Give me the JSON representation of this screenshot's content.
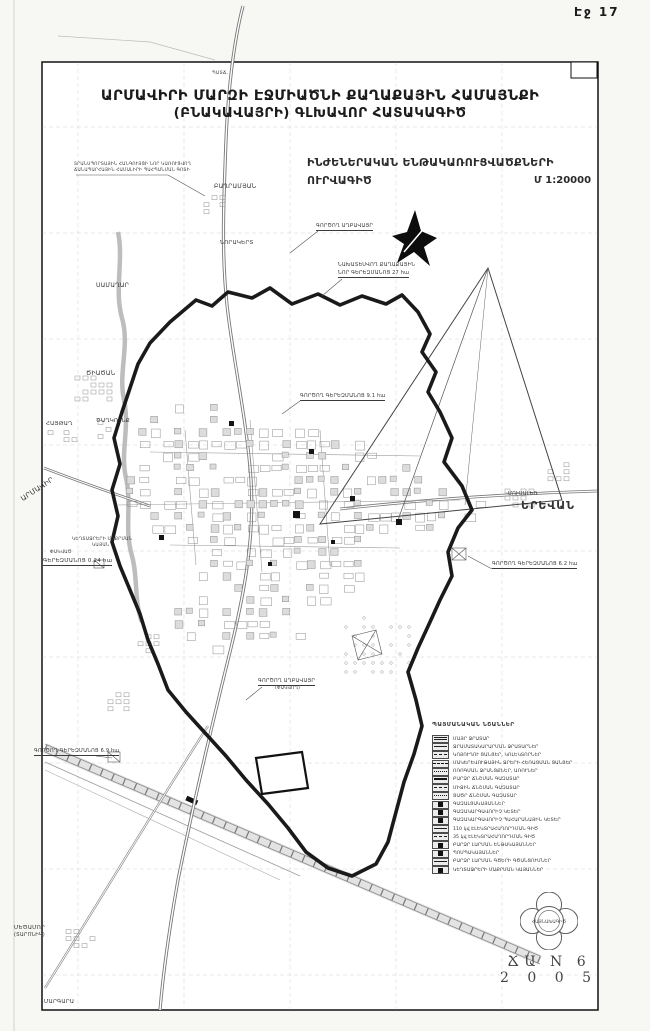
{
  "page": {
    "number_label": "Էջ 17"
  },
  "titles": {
    "line1": "ԱՐՄԱՎԻՐԻ ՄԱՐԶԻ ԷՋՄԻԱԾՆԻ ՔԱՂԱՔԱՅԻՆ ՀԱՄԱՅՆՔԻ",
    "line2": "(ԲՆԱԿԱՎԱՅՐԻ) ԳԼԽԱՎՈՐ ՀԱՏԱԿԱԳԻԾ",
    "subtitle_line1": "ԻՆԺԵՆԵՐԱԿԱՆ ԵՆԹԱԿԱՌՈՒՑՎԱԾՔՆԵՐԻ",
    "subtitle_line2": "ՈՒՐՎԱԳԻԾ",
    "scale": "Մ 1:20000"
  },
  "map_labels": [
    {
      "t": "ՊԱՏՃ.",
      "x": 212,
      "y": 72,
      "s": 4.5
    },
    {
      "t": "ՏՐԱՆՍՊՈՐՏԱՅԻՆ ՀԱՆԳՈՒՅՑԻ ՆՈՐ ԿԱՌՈՒՑՎՈՂ",
      "x": 74,
      "y": 163,
      "s": 4.3
    },
    {
      "t": "ՃԱՆԱՊԱՐՀԱՅԻՆ ՀԱՄԱԼԻՐԻ ՊԱՀՊԱՆՄԱՆ ԳՈՏԻ",
      "x": 74,
      "y": 169,
      "s": 4.3
    },
    {
      "t": "ԲԱՂՐԱՄՅԱՆ",
      "x": 214,
      "y": 184,
      "s": 6
    },
    {
      "t": "ՆՈՐԱԿԵՐՏ",
      "x": 220,
      "y": 240,
      "s": 5.5
    },
    {
      "t": "ԳՈՐԾՈՂ ԱՂԲԱՎԱՅՐ",
      "x": 316,
      "y": 224,
      "s": 5,
      "u": 1
    },
    {
      "t": "ՆԱԽԱՏԵՍՎՈՂ ՔԱՂԱՔԱՅԻՆ",
      "x": 338,
      "y": 263,
      "s": 5
    },
    {
      "t": "ՆՈՐ ԳԵՐԵԶՄԱՆՈՑ 27 հա",
      "x": 338,
      "y": 271,
      "s": 5,
      "u": 1
    },
    {
      "t": "ՍԱՄԱՂԱՐ",
      "x": 96,
      "y": 283,
      "s": 6
    },
    {
      "t": "ԾԻԱԾԱՆ",
      "x": 86,
      "y": 371,
      "s": 6
    },
    {
      "t": "ԳՈՐԾՈՂ ԳԵՐԵԶՄԱՆՈՑ 9.1 հա",
      "x": 300,
      "y": 394,
      "s": 5,
      "u": 1
    },
    {
      "t": "ՀԱՅԹԱՂ",
      "x": 46,
      "y": 421,
      "s": 5.5
    },
    {
      "t": "ԾԱՂԿՈՒՆՔ",
      "x": 96,
      "y": 418,
      "s": 5.5
    },
    {
      "t": "ԱՐՄԱՎԻՐ",
      "x": 20,
      "y": 497,
      "s": 7,
      "r": -33
    },
    {
      "t": "ՄՈՒՍԱԼԵՌ",
      "x": 508,
      "y": 492,
      "s": 5
    },
    {
      "t": "ԵՐԵՎԱՆ",
      "x": 521,
      "y": 500,
      "s": 11,
      "w": 700,
      "ls": 1
    },
    {
      "t": "ԿԵՂՏԱՋՐԵՐԻ ՄԱՔՐՄԱՆ",
      "x": 72,
      "y": 538,
      "s": 4.4
    },
    {
      "t": "ԿԱՅԱՆ",
      "x": 92,
      "y": 544,
      "s": 4.4
    },
    {
      "t": "ՓԱԿՎԱԾ",
      "x": 50,
      "y": 551,
      "s": 4.4
    },
    {
      "t": "ԳԵՐԵԶՄԱՆՈՑ 0.24 հա",
      "x": 43,
      "y": 558,
      "s": 5.5,
      "u": 1
    },
    {
      "t": "ԳՈՐԾՈՂ ԳԵՐԵԶՄԱՆՈՑ 6.2 հա",
      "x": 492,
      "y": 562,
      "s": 5,
      "u": 1
    },
    {
      "t": "ԳՈՐԾՈՂ ԱՂԲԱՎԱՅՐ",
      "x": 258,
      "y": 679,
      "s": 5,
      "u": 1
    },
    {
      "t": "(ՓԱԿՎՈՂ)",
      "x": 275,
      "y": 687,
      "s": 4.4
    },
    {
      "t": "ԳՈՐԾՈՂ ԳԵՐԵԶՄԱՆՈՑ 6.9 հա",
      "x": 34,
      "y": 749,
      "s": 5,
      "u": 1
    },
    {
      "t": "ՄԵԾԱՄՈՐ",
      "x": 14,
      "y": 925,
      "s": 5.5
    },
    {
      "t": "(ՏԱՐՈՆԻԿ)",
      "x": 14,
      "y": 933,
      "s": 5
    },
    {
      "t": "ՄԱՐԳԱՐԱ",
      "x": 44,
      "y": 999,
      "s": 5.5
    }
  ],
  "legend": {
    "title": "ՊԱՅՄԱՆԱԿԱՆ ՆՇԱՆՆԵՐ",
    "items": [
      {
        "label": "ՄԱՅՐ ՋՐԱՏԱՐ",
        "swatch": "double"
      },
      {
        "label": "ՋՐԱՄԱՏԱԿԱՐԱՐՄԱՆ ՋՐԱՏԱՐՆԵՐ",
        "swatch": "solid"
      },
      {
        "label": "ԿՈՅՈՒՂՈՒ ՑԱՆՑԵՐ, ԿՈԼԵԿՏՈՐՆԵՐ",
        "swatch": "dash"
      },
      {
        "label": "ՄԱԿԵՐԵՎՈՒԹԱՅԻՆ ՋՐԵՐԻ ՀԵՌԱՑՄԱՆ ՑԱՆՑԵՐ",
        "swatch": "dashdot"
      },
      {
        "label": "ՈՌՈԳՄԱՆ ՋՐԱՆՑՔՆԵՐ, ԱՌՈՒՆԵՐ",
        "swatch": "dot"
      },
      {
        "label": "ԲԱՐՁՐ ՃՆՇՄԱՆ ԳԱԶԱՏԱՐ",
        "swatch": "thick"
      },
      {
        "label": "ՄԻՋԻՆ ՃՆՇՄԱՆ ԳԱԶԱՏԱՐ",
        "swatch": "dash"
      },
      {
        "label": "ՑԱԾՐ ՃՆՇՄԱՆ ԳԱԶԱՏԱՐ",
        "swatch": "dot"
      },
      {
        "label": "ԳԱԶԱԼՑԱԿԱՅԱՆՆԵՐ",
        "swatch": "square"
      },
      {
        "label": "ԳԱԶԱԿԱՐԳԱՎՈՐԻՉ ԿԵՏԵՐ",
        "swatch": "square"
      },
      {
        "label": "ԳԱԶԱԿԱՐԳԱՎՈՐԻՉ ՊԱՀԱՐԱՆԱՅԻՆ ԿԵՏԵՐ",
        "swatch": "square"
      },
      {
        "label": "110 կվ ԷԼԵԿՏՐԱՀԱՂՈՐԴՄԱՆ ԳԻԾ",
        "swatch": "solid"
      },
      {
        "label": "35 կվ ԷԼԵԿՏՐԱՀԱՂՈՐԴՄԱՆ ԳԻԾ",
        "swatch": "dash"
      },
      {
        "label": "ԲԱՐՁՐ ԼԱՐՄԱՆ ԵՆԹԱԿԱՅԱՆՆԵՐ",
        "swatch": "square"
      },
      {
        "label": "ՊՈՄՊԱԿԱՅԱՆՆԵՐ",
        "swatch": "square"
      },
      {
        "label": "ԲԱՐՁՐ ԼԱՐՄԱՆ ԳԾԵՐԻ ԳԾԱՆՑՈՒՄՆԵՐ",
        "swatch": "solid"
      },
      {
        "label": "ԿԵՂՏԱՋՐԵՐԻ ՄԱՔՐՄԱՆ ԿԱՅԱՆՆԵՐ",
        "swatch": "square"
      }
    ]
  },
  "stamp": {
    "logo_text": "ՀԱՅՆԱԽԱԳԻԾ",
    "series": "ՃԱ N 6",
    "year": "2 0 0 5"
  }
}
